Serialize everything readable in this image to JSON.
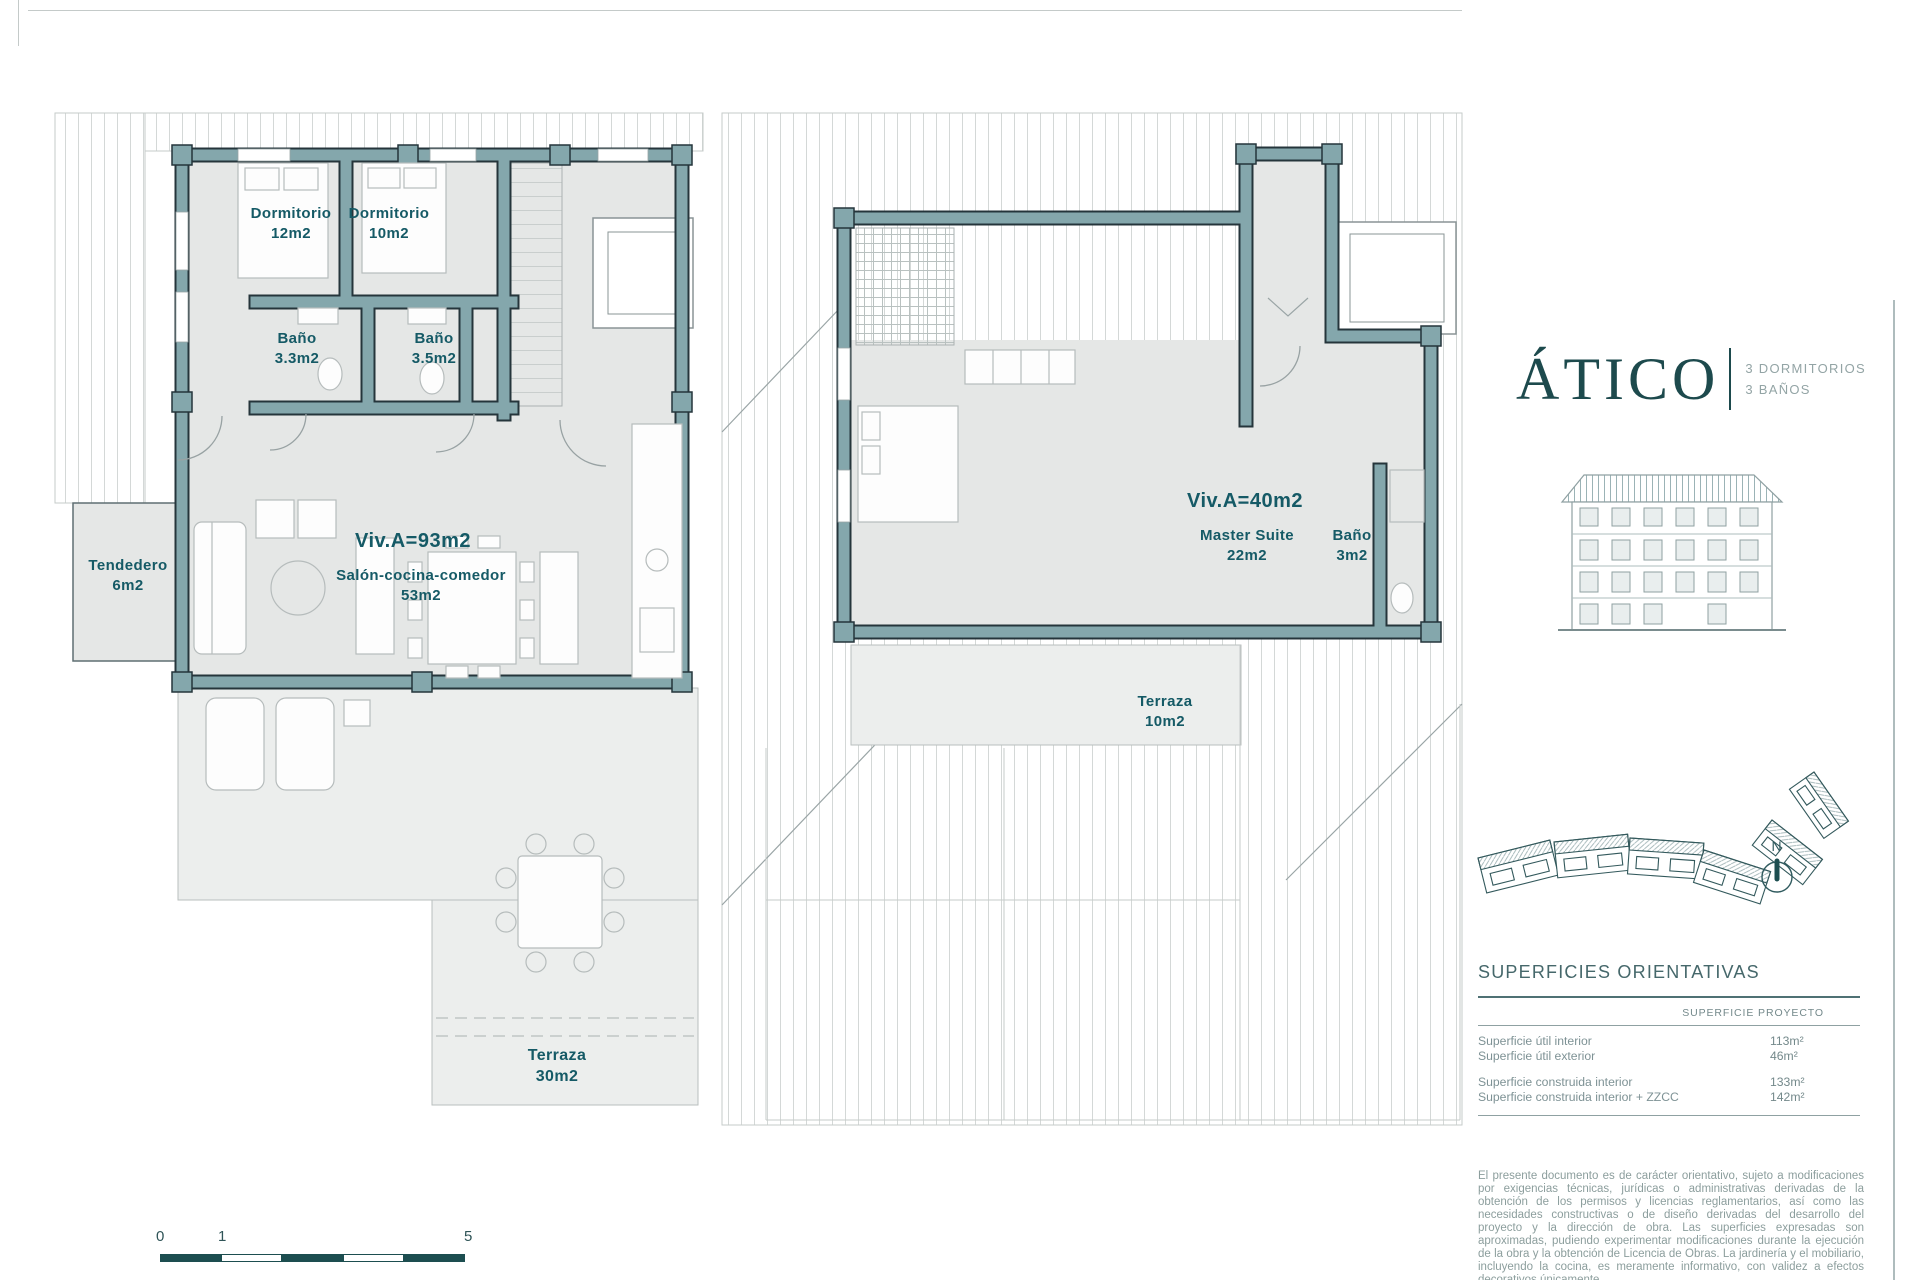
{
  "title_block": {
    "title": "ÁTICO",
    "spec_lines": [
      "3 DORMITORIOS",
      "3 BAÑOS"
    ]
  },
  "plan_main": {
    "unit_area_label": "Viv.A=93m2",
    "rooms": {
      "dormitorio1": {
        "name": "Dormitorio",
        "area": "12m2"
      },
      "dormitorio2": {
        "name": "Dormitorio",
        "area": "10m2"
      },
      "bano1": {
        "name": "Baño",
        "area": "3.3m2"
      },
      "bano2": {
        "name": "Baño",
        "area": "3.5m2"
      },
      "salon": {
        "name": "Salón-cocina-comedor",
        "area": "53m2"
      },
      "tendedero": {
        "name": "Tendedero",
        "area": "6m2"
      },
      "terraza": {
        "name": "Terraza",
        "area": "30m2"
      }
    }
  },
  "plan_upper": {
    "unit_area_label": "Viv.A=40m2",
    "rooms": {
      "master": {
        "name": "Master Suite",
        "area": "22m2"
      },
      "bano": {
        "name": "Baño",
        "area": "3m2"
      },
      "terraza": {
        "name": "Terraza",
        "area": "10m2"
      }
    }
  },
  "surfaces_table": {
    "heading": "SUPERFICIES ORIENTATIVAS",
    "column_header": "SUPERFICIE PROYECTO",
    "rows": [
      {
        "label": "Superficie útil interior",
        "value": "113m²"
      },
      {
        "label": "Superficie útil exterior",
        "value": "46m²"
      },
      {
        "label": "Superficie construida interior",
        "value": "133m²"
      },
      {
        "label": "Superficie construida interior + ZZCC",
        "value": "142m²"
      }
    ]
  },
  "disclaimer": "El presente documento es de carácter orientativo, sujeto a modificaciones por exigencias técnicas, jurídicas o administrativas derivadas de la obtención de los permisos y licencias reglamentarios, así como las necesidades constructivas o de diseño derivadas del desarrollo del proyecto y la dirección de obra. Las superficies expresadas son aproximadas, pudiendo experimentar modificaciones durante la ejecución de la obra y la obtención de Licencia de Obras. La jardinería y el mobiliario, incluyendo la cocina, es meramente informativo, con validez a efectos decorativos únicamente.",
  "scale_bar": {
    "labels": [
      "0",
      "1",
      "5"
    ]
  },
  "compass": {
    "label": "N"
  },
  "colors": {
    "wall": "#84a7ac",
    "wall_outline": "#25353b",
    "floor": "#e5e7e6",
    "label_text": "#155a66",
    "title_text": "#1d4a4d",
    "muted_text": "#8c9e9d",
    "scale_bar": "#1d4e50"
  }
}
